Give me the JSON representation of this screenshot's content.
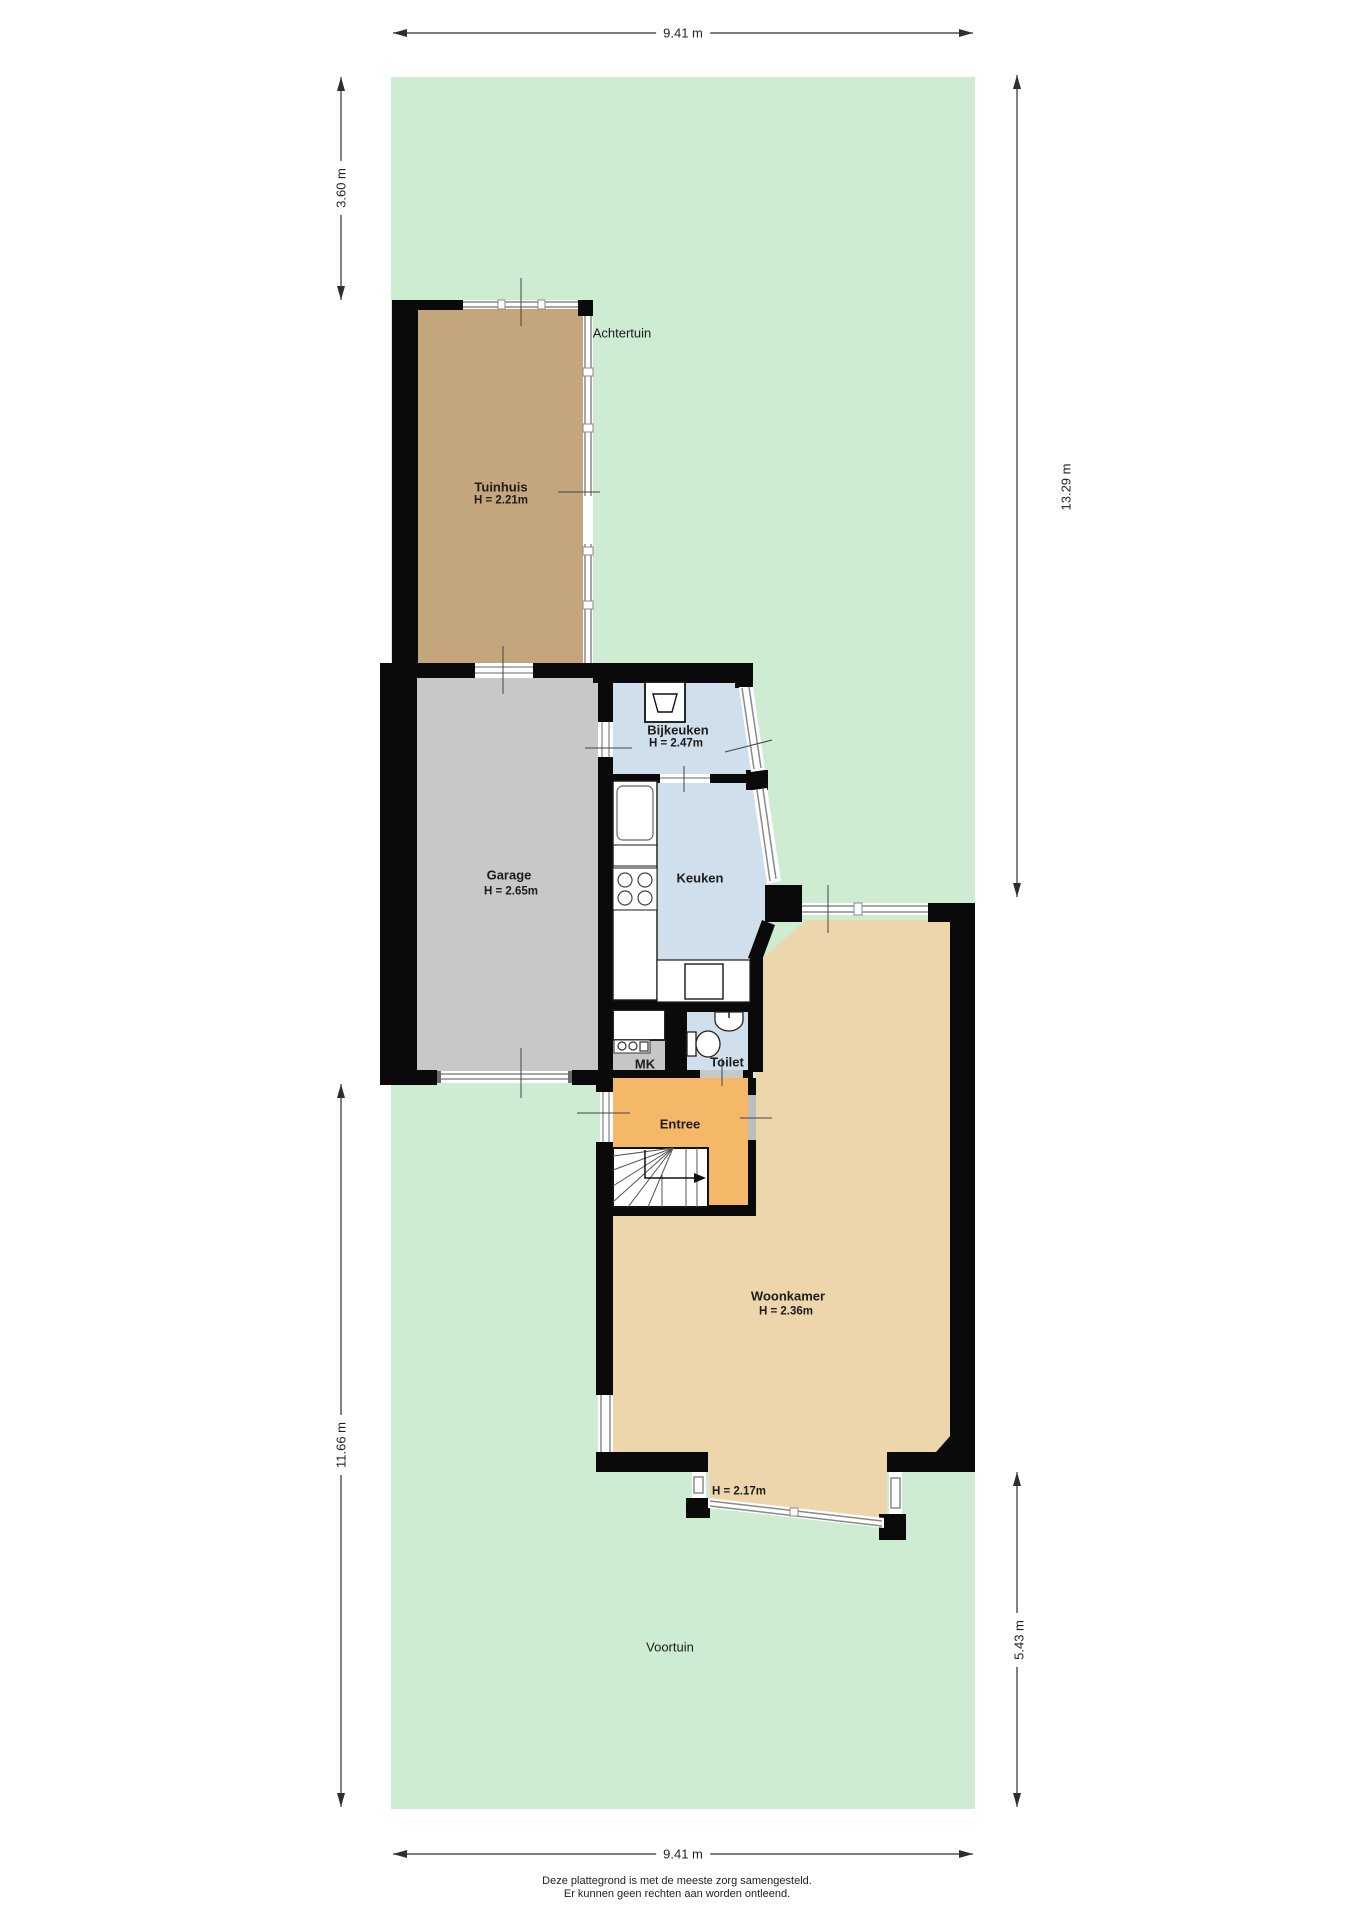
{
  "dimensions": {
    "width_top": "9.41 m",
    "width_bottom": "9.41 m",
    "left_upper": "3.60 m",
    "left_lower": "11.66 m",
    "right_upper": "13.29 m",
    "right_lower": "5.43 m"
  },
  "rooms": {
    "achtertuin": {
      "name": "Achtertuin"
    },
    "voortuin": {
      "name": "Voortuin"
    },
    "tuinhuis": {
      "name": "Tuinhuis",
      "h": "H = 2.21m"
    },
    "garage": {
      "name": "Garage",
      "h": "H = 2.65m"
    },
    "bijkeuken": {
      "name": "Bijkeuken",
      "h": "H = 2.47m"
    },
    "keuken": {
      "name": "Keuken"
    },
    "toilet": {
      "name": "Toilet"
    },
    "mk": {
      "name": "MK"
    },
    "entree": {
      "name": "Entree"
    },
    "woonkamer": {
      "name": "Woonkamer",
      "h": "H = 2.36m",
      "bay_h": "H = 2.17m"
    }
  },
  "footer": {
    "line1": "Deze plattegrond is met de meeste zorg samengesteld.",
    "line2": "Er kunnen geen rechten aan worden ontleend."
  },
  "colors": {
    "garden": "#cdecd2",
    "tuinhuis_floor": "#c4a67d",
    "garage_floor": "#c8c8c8",
    "wet_room_floor": "#cfdfeb",
    "entree_floor": "#f5b869",
    "woonkamer_floor": "#eed6ac",
    "mk_floor": "#c6c6c6",
    "wall": "#0a0a0a",
    "window_line": "#8a8a8a",
    "dimension_line": "#2e2e2e"
  }
}
